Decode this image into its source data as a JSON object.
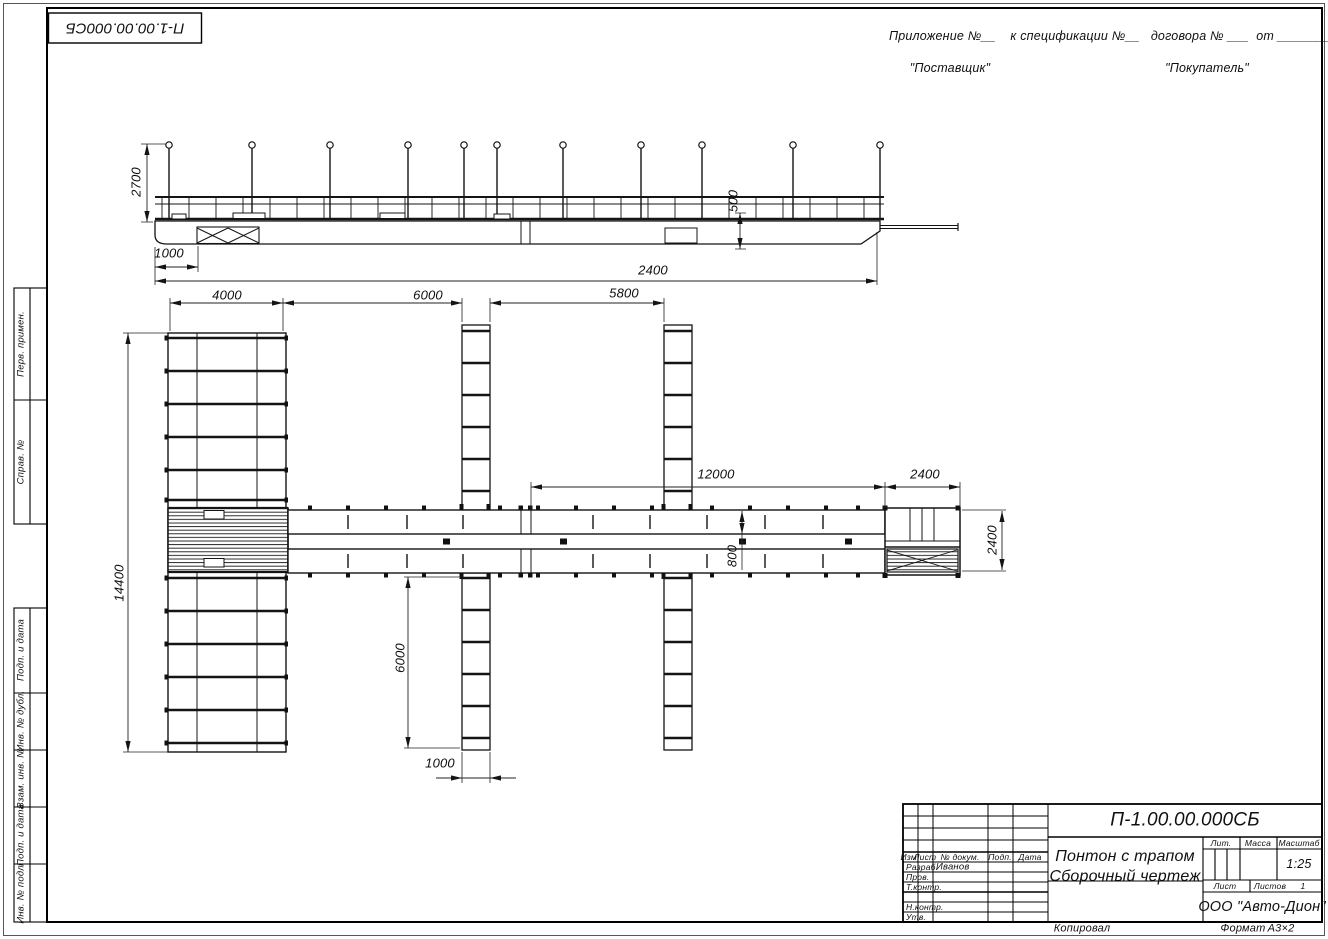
{
  "sheet": {
    "corner_doc_number": "П-1.00.00.000СБ",
    "annex_line": "Приложение №__    к спецификации №__   договора № ___  от ________",
    "supplier": "\"Поставщик\"",
    "buyer": "\"Покупатель\"",
    "copied_label": "Копировал",
    "format_label": "Формат",
    "format_value": "А3×2"
  },
  "side_stamps": {
    "perv_primen": "Перв. примен.",
    "sprav_no": "Справ. №",
    "podp_data_1": "Подп. и дата",
    "inv_dubl": "Инв. № дубл.",
    "vzam_inv": "Взам. инв. №",
    "podp_data_2": "Подп. и дата",
    "inv_podl": "Инв. № подл."
  },
  "title_block": {
    "doc_number": "П-1.00.00.000СБ",
    "title_line1": "Понтон с трапом",
    "title_line2": "Сборочный чертеж",
    "col_izm": "Изм.",
    "col_list": "Лист",
    "col_doc": "№ докум.",
    "col_podp": "Подп.",
    "col_data": "Дата",
    "row_razrab": "Разраб.",
    "razrab_name": "Иванов",
    "row_prov": "Пров.",
    "row_tkontr": "Т.контр.",
    "row_nkontr": "Н.контр.",
    "row_utv": "Утв.",
    "lit_label": "Лит.",
    "massa_label": "Масса",
    "masshtab_label": "Масштаб",
    "scale_value": "1:25",
    "list_label": "Лист",
    "listov_label": "Листов",
    "listov_value": "1",
    "company": "ООО \"Авто-Дион\""
  },
  "dimensions": {
    "mast_height": "2700",
    "gangway_offset": "1000",
    "freeboard": "500",
    "overall": "2400",
    "pier_width": "4000",
    "bay_spacing1": "6000",
    "bay_spacing2": "5800",
    "walkway_length": "12000",
    "platform_length": "2400",
    "pier_length": "14400",
    "lane_width": "800",
    "platform_width": "2400",
    "finger_length": "6000",
    "finger_width": "1000"
  }
}
